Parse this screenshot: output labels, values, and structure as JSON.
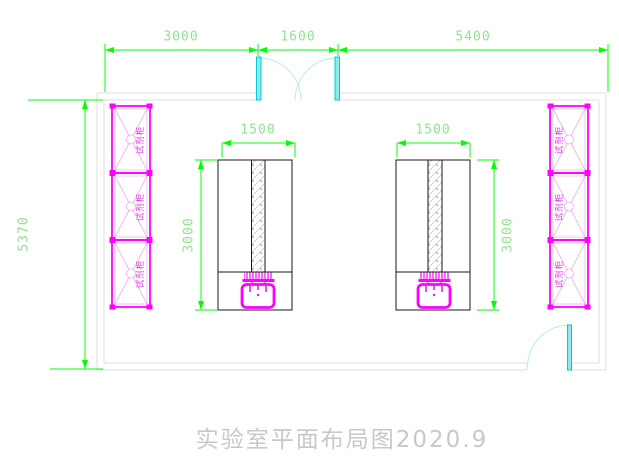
{
  "title": {
    "text": "实验室平面布局图2020.9"
  },
  "room": {
    "dimensions": {
      "top_segments": [
        {
          "label": "3000"
        },
        {
          "label": "1600"
        },
        {
          "label": "5400"
        }
      ],
      "overall_height": {
        "label": "5370"
      }
    }
  },
  "benches": {
    "left": {
      "width_label": "1500",
      "length_label": "3000"
    },
    "right": {
      "width_label": "1500",
      "length_label": "3000"
    }
  },
  "cabinets": {
    "left": {
      "cells": [
        {
          "label": "试剂柜"
        },
        {
          "label": "试剂柜"
        },
        {
          "label": "试剂柜"
        }
      ]
    },
    "right": {
      "cells": [
        {
          "label": "试剂柜"
        },
        {
          "label": "试剂柜"
        },
        {
          "label": "试剂柜"
        }
      ]
    }
  },
  "colors": {
    "dimension_line_green": "#00ff00",
    "dimension_text_green": "#8fe48f",
    "equipment_magenta": "#ff00ff",
    "cabinet_text_magenta": "#e23ae2",
    "door_leaf_cyan": "#8deaec",
    "door_arc_cyan": "#b5ecee",
    "wall_gray": "#dcdcdc",
    "bench_outline_black": "#1a1a1a",
    "title_gray": "#c8c8c8",
    "background": "#ffffff"
  }
}
